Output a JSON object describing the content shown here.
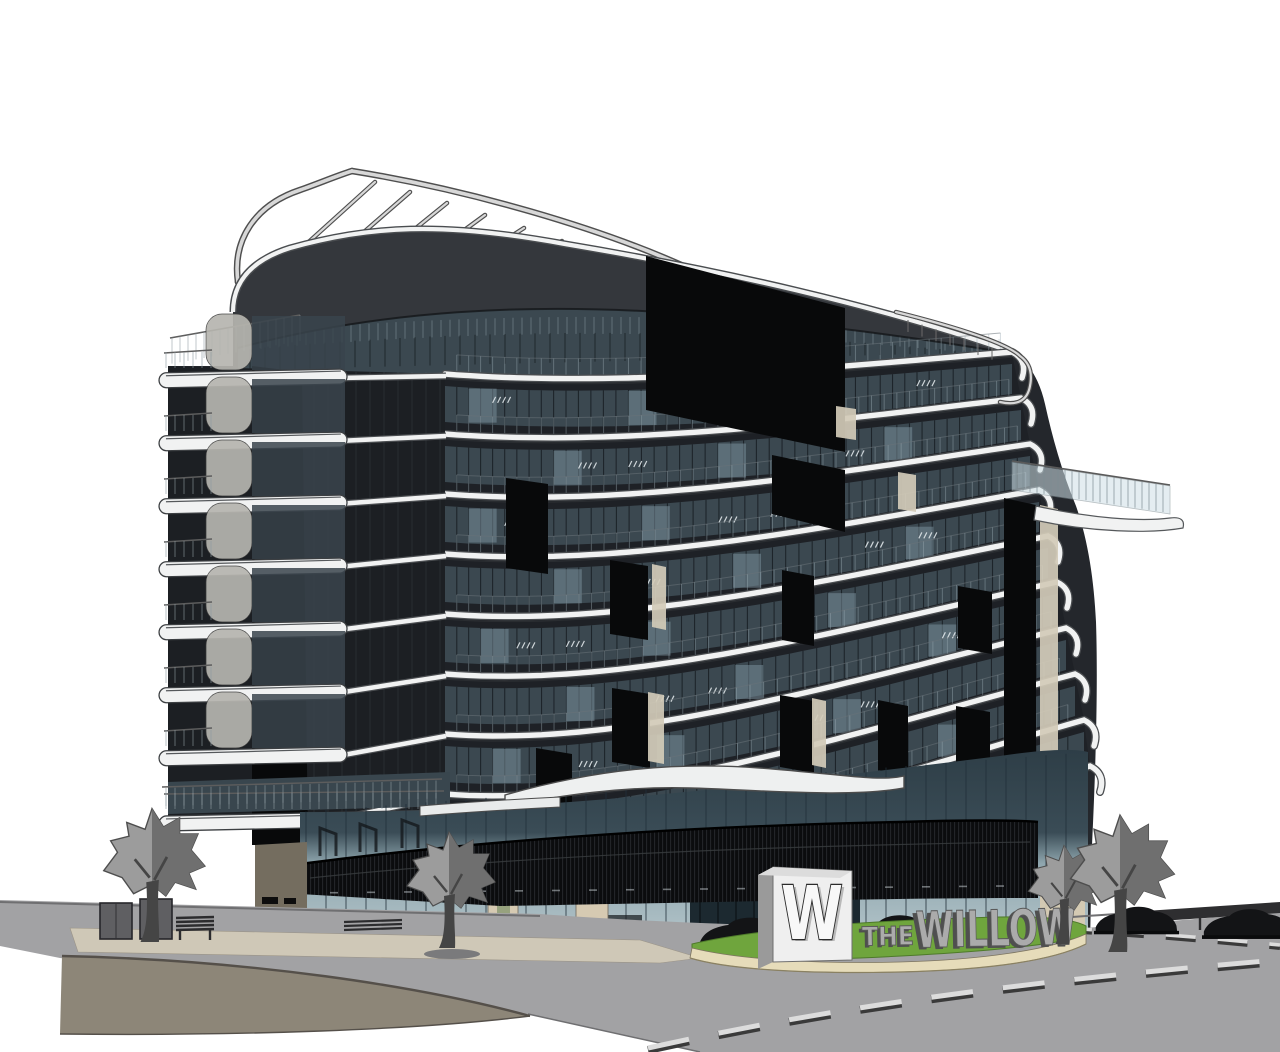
{
  "scene": {
    "type": "3D architectural rendering",
    "subject": "curved multi-storey apartment building on a corner site with entry drive",
    "background_color": "#ffffff"
  },
  "building": {
    "name": "The Willow",
    "floors_visible": 10,
    "rooftop_feature": "curved steel pergola trellis",
    "facade": "dark curtain wall with sweeping white slab bands and stacked curved balconies"
  },
  "signage": {
    "monument_logo": "W",
    "sign_prefix": "THE",
    "sign_name": "WILLOW"
  },
  "site": {
    "trees_count": 4,
    "cars_count": 4,
    "road_marking": "dashed centerline",
    "street_furniture": [
      "planter boxes",
      "bench"
    ]
  },
  "palette": {
    "bg": "#ffffff",
    "facade": "#24272c",
    "band": "#1e2126",
    "slab": "#f1f2f2",
    "slabEdge": "#4a4d50",
    "glass": "#3b4850",
    "glassDark": "#161c21",
    "glassLight": "#7e93a0",
    "sparkle": "#e9eff2",
    "panelBlack": "#08090a",
    "cream": "#d2cbb9",
    "fascia": "#34373c",
    "tube": "#d8d8d8",
    "tubeEdge": "#4f4f4f",
    "railGlass": "#cfe0e6",
    "louver": "#0b0c0e",
    "storefront": "#aabfc6",
    "storeDark": "#2e3e47",
    "taupe": "#746d5f",
    "fin": "#d6cab2",
    "plaza": "#cfc8b7",
    "wallFace": "#8d8678",
    "wallTop": "#55504a",
    "road": "#a2a2a4",
    "roadLine": "#dcdcdc",
    "grass": "#6fa53d",
    "grassEdge": "#4e7a2a",
    "curb": "#e6dcba",
    "treeLight": "#9c9c9c",
    "treeDark": "#6f6f6f",
    "treeEdge": "#4e4e4e",
    "trunk": "#454545",
    "car": "#131416",
    "signWhite": "#efefef",
    "signSide": "#9a9a9a",
    "letterFace": "#ababab",
    "letterEdge": "#5a5a5a",
    "letterSide": "#4f4f4f"
  }
}
